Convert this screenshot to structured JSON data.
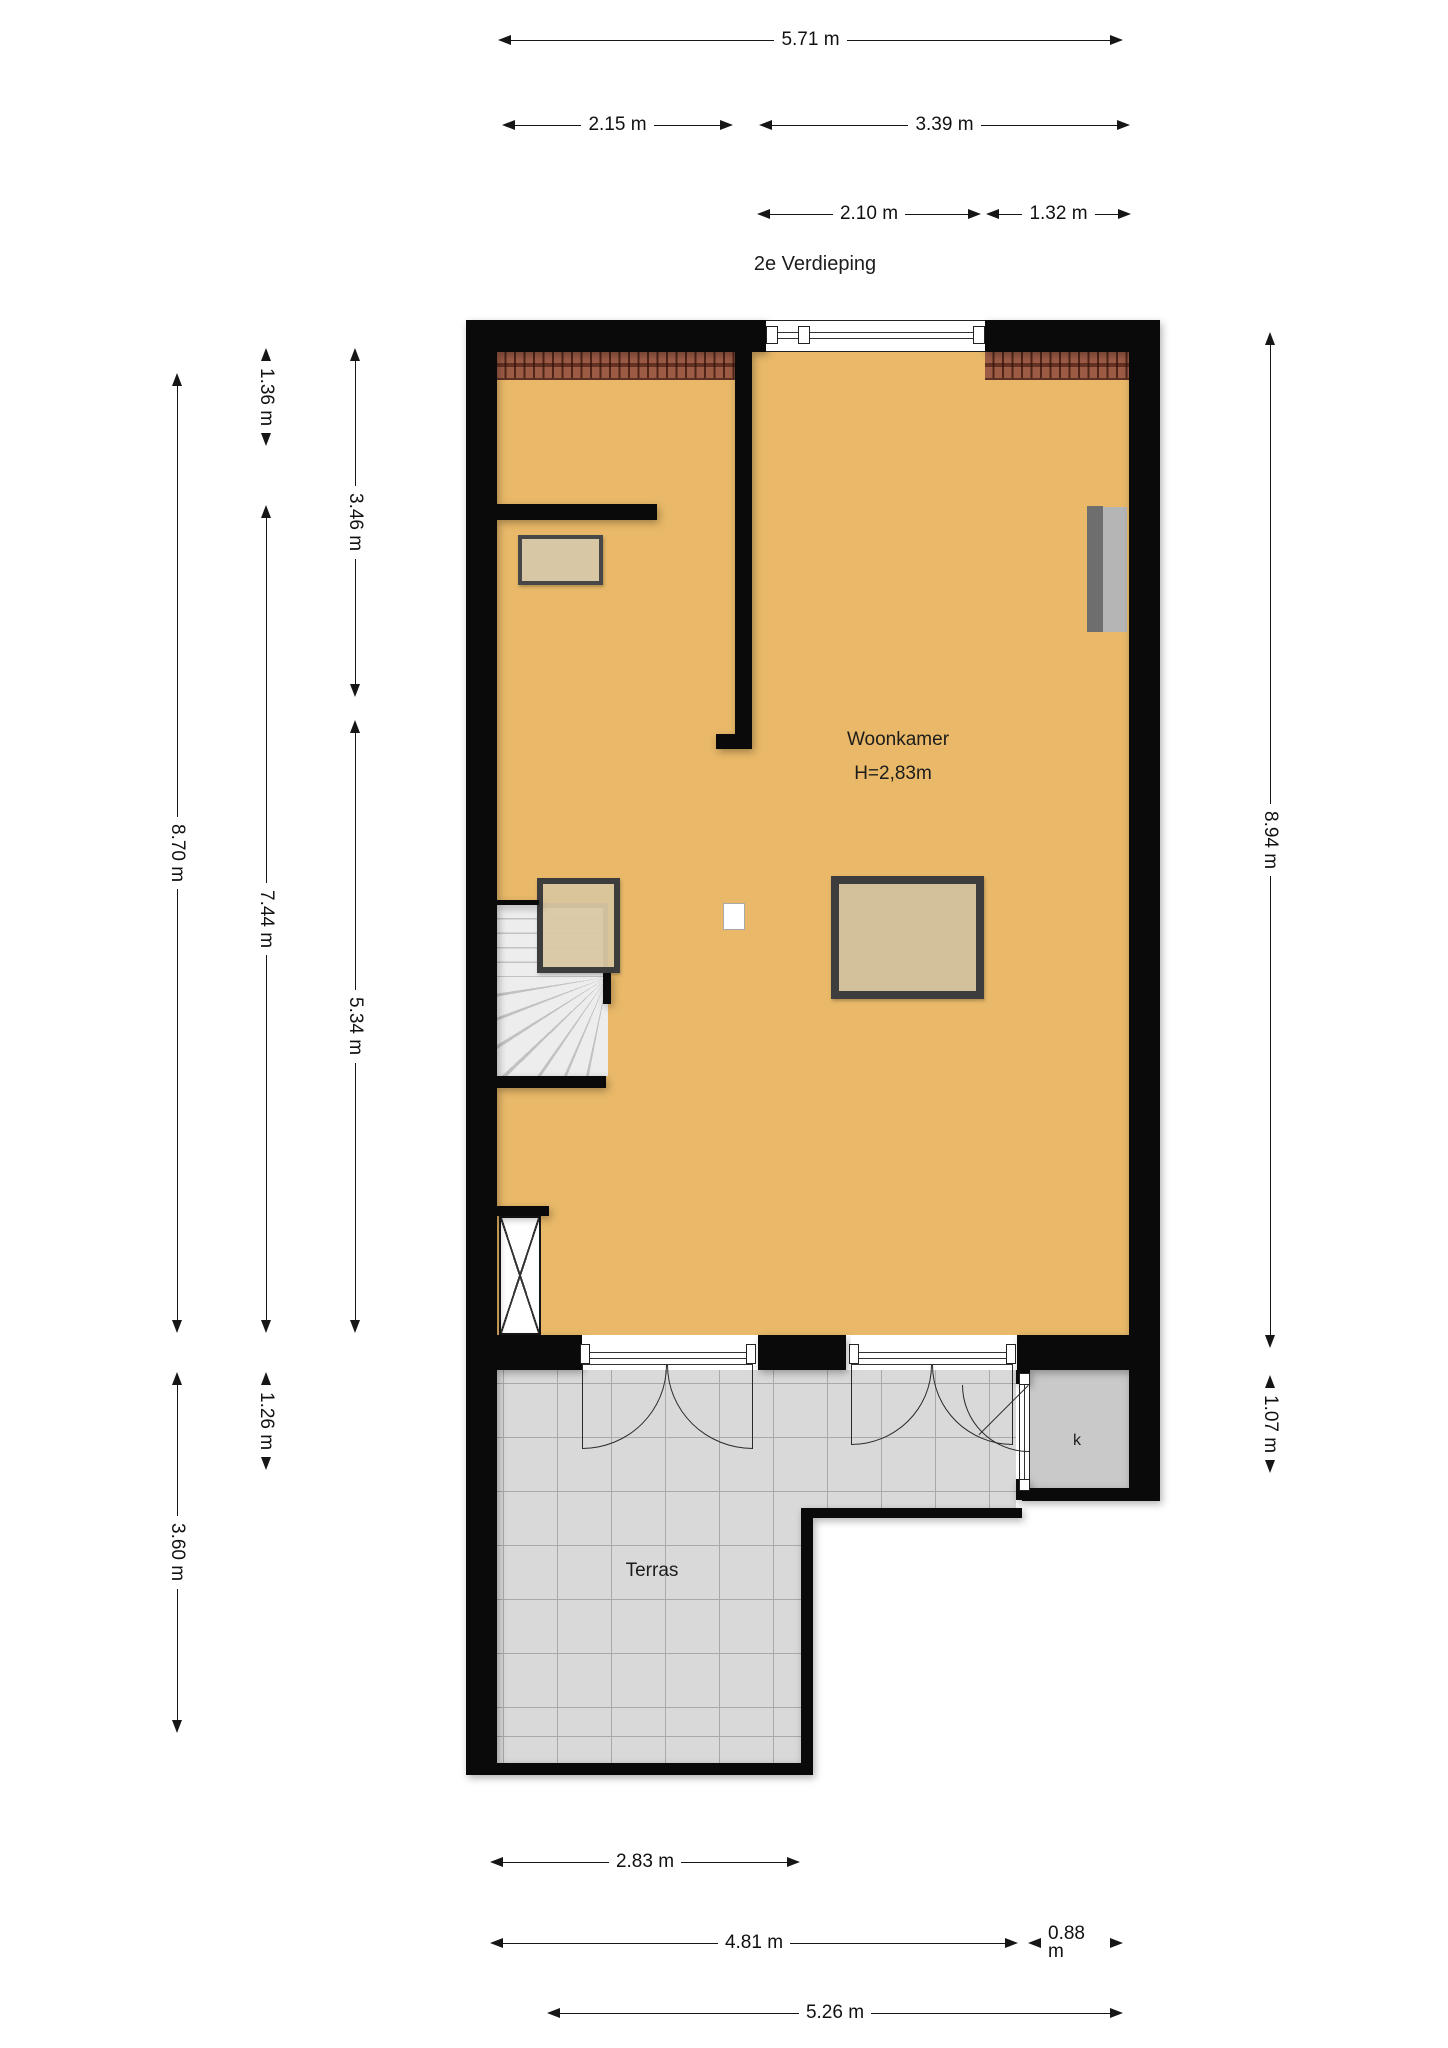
{
  "title": "2e Verdieping",
  "rooms": {
    "living": "Woonkamer",
    "living_height": "H=2,83m",
    "terrace": "Terras",
    "closet": "k"
  },
  "dimensions": {
    "top_total": "5.71 m",
    "top_left": "2.15 m",
    "top_right": "3.39 m",
    "top_window": "2.10 m",
    "top_corner": "1.32 m",
    "left_136": "1.36 m",
    "left_346": "3.46 m",
    "left_870": "8.70 m",
    "left_744": "7.44 m",
    "left_534": "5.34 m",
    "left_126": "1.26 m",
    "left_360": "3.60 m",
    "right_894": "8.94 m",
    "right_107": "1.07 m",
    "bottom_283": "2.83 m",
    "bottom_481": "4.81 m",
    "bottom_088": "0.88 m",
    "bottom_526": "5.26 m"
  },
  "colors": {
    "wall": "#0a0a0a",
    "floor": "#e9b969",
    "rooftile": "#9c5b45",
    "roofdark": "#4f2619",
    "terrace": "#d9d9d9",
    "terraceline": "#a9a9a9",
    "kroom": "#c9c9c9",
    "tablefill": "#d3c19b",
    "tableborder": "#3d3d3d",
    "stair": "#ededed",
    "stairline": "#c2c2c2",
    "tvdark": "#6e6e6e",
    "tvlight": "#b5b5b5",
    "ink": "#111111"
  }
}
